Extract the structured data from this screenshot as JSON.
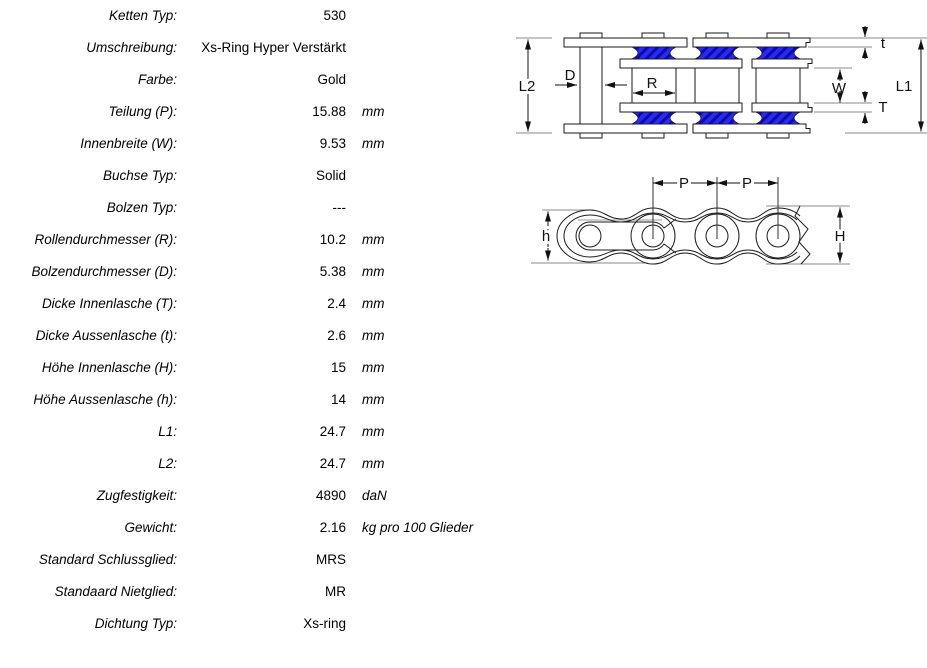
{
  "table": {
    "rows": [
      {
        "label": "Ketten Typ:",
        "value": "530",
        "unit": ""
      },
      {
        "label": "Umschreibung:",
        "value": "Xs-Ring Hyper Verstärkt",
        "unit": ""
      },
      {
        "label": "Farbe:",
        "value": "Gold",
        "unit": ""
      },
      {
        "label": "Teilung (P):",
        "value": "15.88",
        "unit": "mm"
      },
      {
        "label": "Innenbreite (W):",
        "value": "9.53",
        "unit": "mm"
      },
      {
        "label": "Buchse Typ:",
        "value": "Solid",
        "unit": ""
      },
      {
        "label": "Bolzen Typ:",
        "value": "---",
        "unit": ""
      },
      {
        "label": "Rollendurchmesser (R):",
        "value": "10.2",
        "unit": "mm"
      },
      {
        "label": "Bolzendurchmesser (D):",
        "value": "5.38",
        "unit": "mm"
      },
      {
        "label": "Dicke Innenlasche (T):",
        "value": "2.4",
        "unit": "mm"
      },
      {
        "label": "Dicke Aussenlasche (t):",
        "value": "2.6",
        "unit": "mm"
      },
      {
        "label": "Höhe Innenlasche (H):",
        "value": "15",
        "unit": "mm"
      },
      {
        "label": "Höhe Aussenlasche (h):",
        "value": "14",
        "unit": "mm"
      },
      {
        "label": "L1:",
        "value": "24.7",
        "unit": "mm"
      },
      {
        "label": "L2:",
        "value": "24.7",
        "unit": "mm"
      },
      {
        "label": "Zugfestigkeit:",
        "value": "4890",
        "unit": "daN"
      },
      {
        "label": "Gewicht:",
        "value": "2.16",
        "unit": "kg pro 100 Glieder"
      },
      {
        "label": "Standard Schlussglied:",
        "value": "MRS",
        "unit": ""
      },
      {
        "label": "Standaard Nietglied:",
        "value": "MR",
        "unit": ""
      },
      {
        "label": "Dichtung Typ:",
        "value": "Xs-ring",
        "unit": ""
      }
    ]
  },
  "diagram": {
    "labels": {
      "L2": "L2",
      "D": "D",
      "R": "R",
      "t": "t",
      "W": "W",
      "T": "T",
      "L1": "L1",
      "P1": "P",
      "P2": "P",
      "h": "h",
      "H": "H"
    },
    "colors": {
      "seal_fill": "#2b2bf0",
      "seal_hatch": "#0b0bb0",
      "outline": "#1a1a1a",
      "extension_line": "#8a8a8a"
    }
  }
}
